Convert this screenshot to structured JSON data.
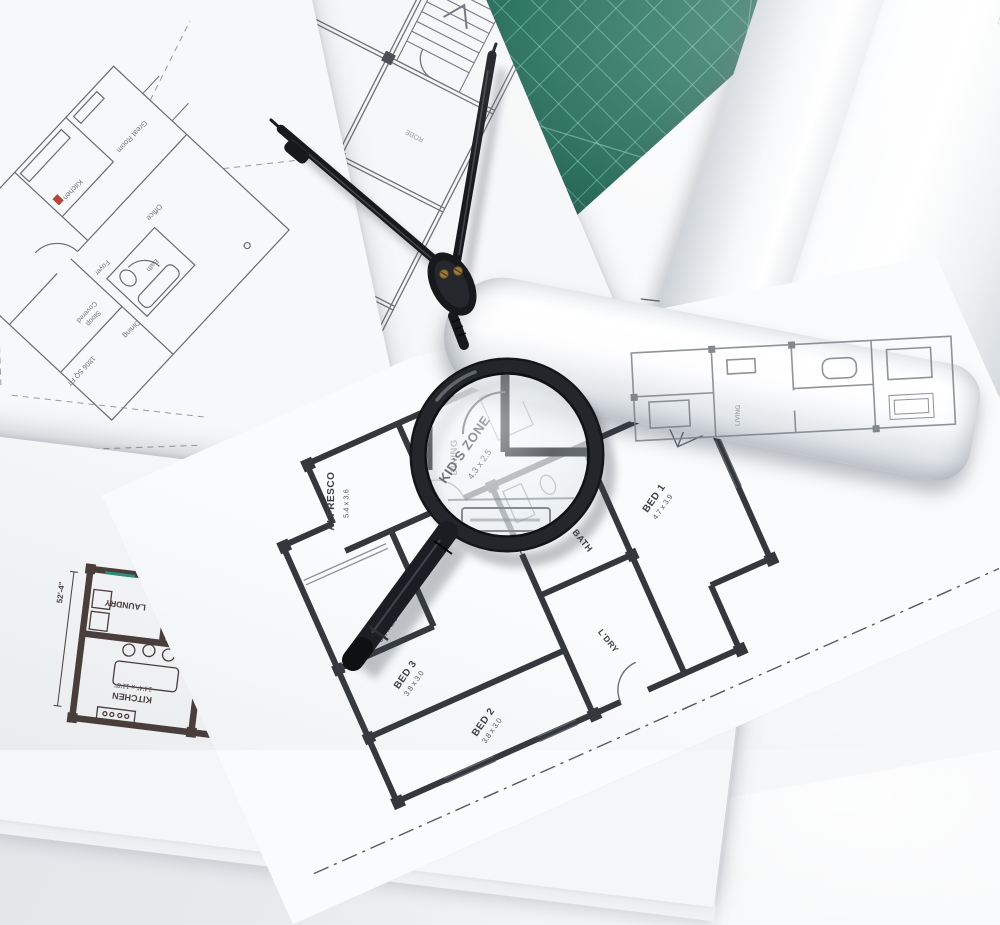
{
  "colors": {
    "mat_green": "#1a6a53",
    "mat_grid": "#91e1c6",
    "paper": "#f8f9fa",
    "thin_line": "#6a7076",
    "bold_wall": "#34383c",
    "brown_wall": "#493c3a",
    "teal_accent": "#2f8f77",
    "tool_black": "#17191c",
    "red_marker": "#b5463c",
    "brass": "#9a7a3a"
  },
  "cutting_mat": {
    "primary_scale": [
      "28",
      "27",
      "26",
      "25",
      "24",
      "23",
      "22",
      "21",
      "20",
      "19",
      "18",
      "17"
    ],
    "secondary_scale": [
      "0",
      "1",
      "2",
      "3",
      "4",
      "5",
      "6",
      "7",
      "8"
    ]
  },
  "sheet_left": {
    "labels": {
      "sqft": "1806 SQ FT",
      "stoop1": "Covered",
      "stoop2": "Stoop",
      "foyer": "Foyer",
      "kitchen": "Kitchen",
      "dining": "Dining",
      "bath": "Bath",
      "office": "Office",
      "great_room": "Great Room"
    }
  },
  "sheet_top": {
    "labels": {
      "toilet": "TOILET",
      "kitchen": "KITCHEN",
      "dining": "DINING",
      "living": "LIVING",
      "bed": "BED",
      "robe": "ROBE"
    }
  },
  "sheet_right": {
    "labels": {
      "porch": "PORCH",
      "study": "STUDY",
      "study_dims": "3.0 x 2.5",
      "entry": "ENTRY"
    }
  },
  "sheet_main": {
    "labels": {
      "bed4": "BED 4",
      "bed4_dims": "3.8 x 3.0",
      "bed3": "BED 3",
      "bed3_dims": "3.8 x 3.0",
      "bed2": "BED 2",
      "bed2_dims": "3.8 x 3.0",
      "bed1": "BED 1",
      "bed1_dims": "4.7 x 3.9",
      "kids_zone": "KID'S ZONE",
      "kids_zone_dims": "4.3 x 2.5",
      "ens": "ENS",
      "bath": "BATH",
      "ldry": "L'DRY",
      "ref": "REF",
      "dining": "DINING",
      "alfresco": "ALFRESCO",
      "alfresco_dims": "5.4 x 3.6"
    }
  },
  "sheet_bottom": {
    "labels": {
      "great_room": "GREAT ROOM",
      "great_room_dims": "16'0\" x 21'4\"",
      "great_room_note": "VAULTED CEILING",
      "kitchen": "KITCHEN",
      "kitchen_dims": "14'4\" x 11'8\"",
      "laundry": "LAUNDRY",
      "mud": "MUD",
      "foyer": "FOYER",
      "foyer_note": "12'0\" HIGH CEILING",
      "wi_clst": "W/I CLST",
      "bath": "BATH",
      "dn": "DN",
      "dim": "52'-4\""
    }
  },
  "roll_small": {
    "label": "LIVING"
  }
}
